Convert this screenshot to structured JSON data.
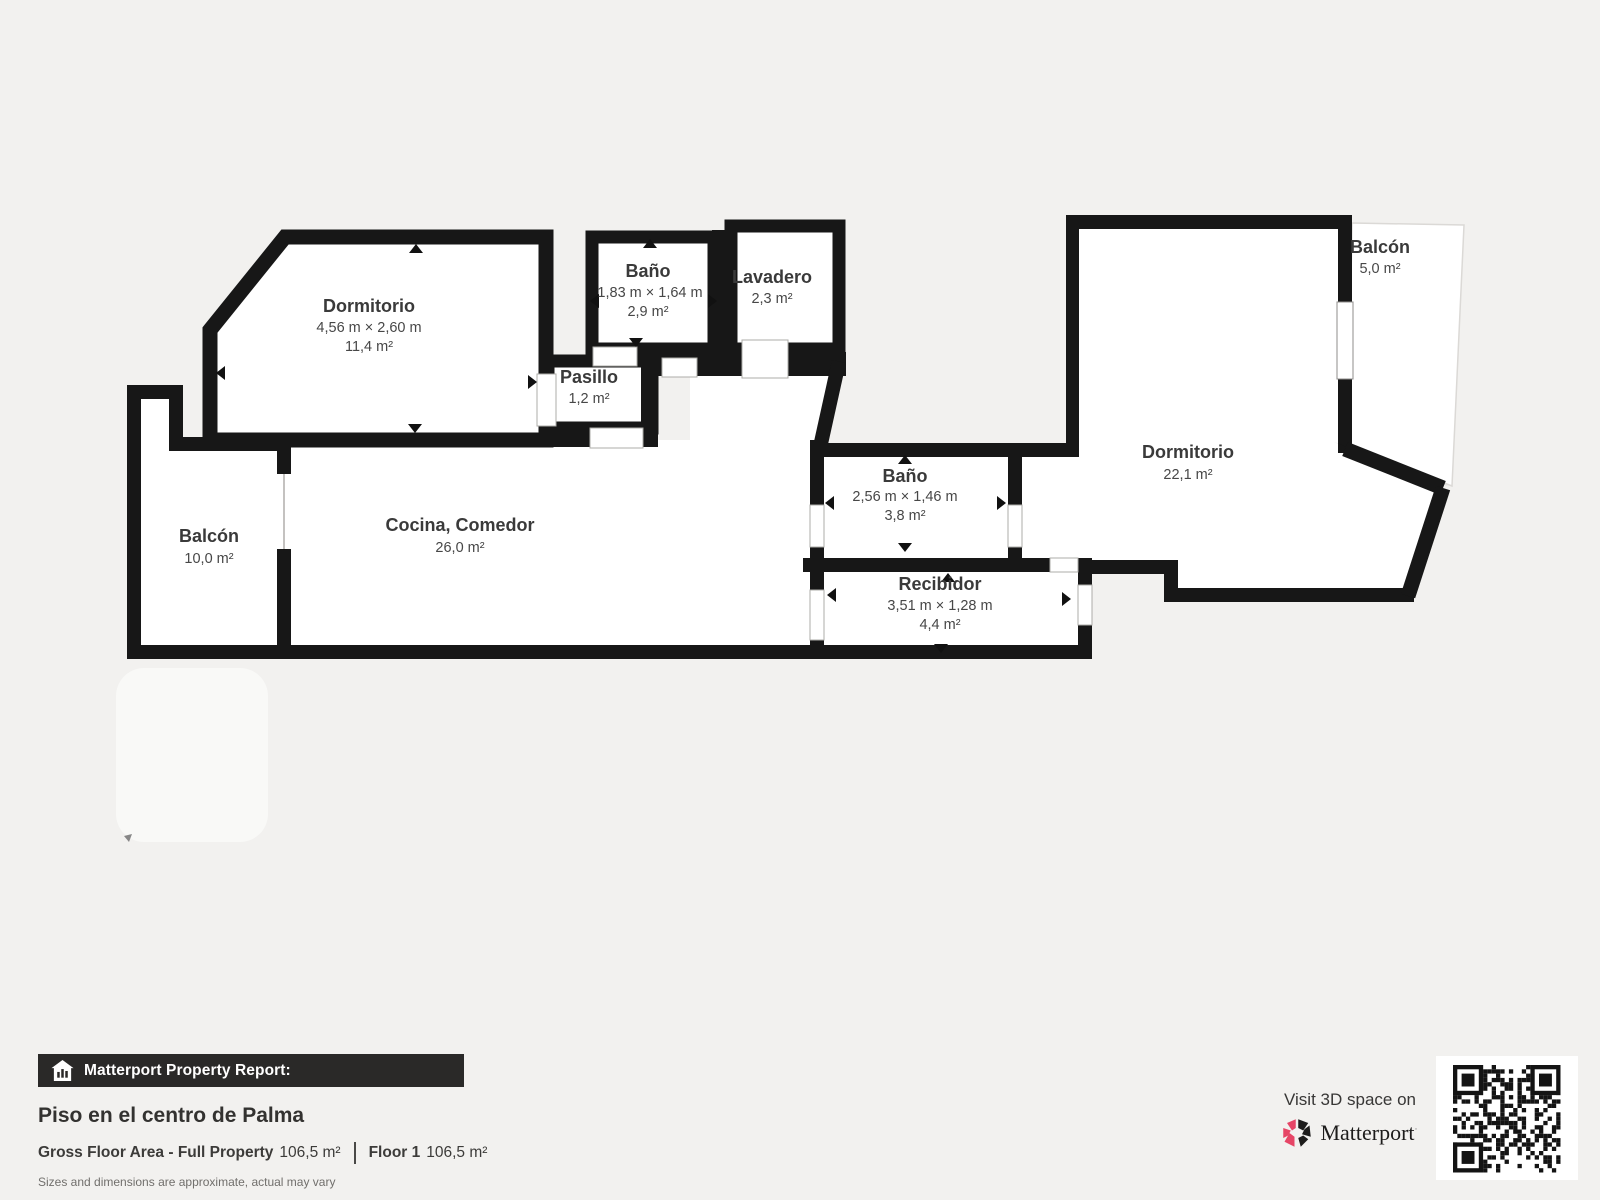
{
  "rooms": {
    "dormitorio1": {
      "name": "Dormitorio",
      "dims": "4,56 m × 2,60 m",
      "area": "11,4 m²"
    },
    "bano1": {
      "name": "Baño",
      "dims": "1,83 m × 1,64 m",
      "area": "2,9 m²"
    },
    "lavadero": {
      "name": "Lavadero",
      "area": "2,3 m²"
    },
    "pasillo": {
      "name": "Pasillo",
      "area": "1,2 m²"
    },
    "balcon1": {
      "name": "Balcón",
      "area": "10,0 m²"
    },
    "cocina": {
      "name": "Cocina, Comedor",
      "area": "26,0 m²"
    },
    "bano2": {
      "name": "Baño",
      "dims": "2,56 m × 1,46 m",
      "area": "3,8 m²"
    },
    "recibidor": {
      "name": "Recibidor",
      "dims": "3,51 m × 1,28 m",
      "area": "4,4 m²"
    },
    "dormitorio2": {
      "name": "Dormitorio",
      "area": "22,1 m²"
    },
    "balcon2": {
      "name": "Balcón",
      "area": "5,0 m²"
    }
  },
  "footer": {
    "report_label": "Matterport Property Report:",
    "property_title": "Piso en el centro de Palma",
    "gross_label": "Gross Floor Area - Full Property",
    "gross_value": "106,5 m²",
    "floor_label": "Floor 1",
    "floor_value": "106,5 m²",
    "disclaimer": "Sizes and dimensions are approximate, actual may vary",
    "visit_text": "Visit 3D space on",
    "brand": "Matterport"
  },
  "icons": {
    "report_bar_icon": "house-stats-icon",
    "brand_icon": "matterport-pinwheel-icon",
    "qr": "qr-code"
  },
  "colors": {
    "background": "#f2f1ef",
    "wall": "#171717",
    "room_fill": "#ffffff",
    "brand_pink": "#e64566",
    "bar_background": "#2a2928"
  }
}
